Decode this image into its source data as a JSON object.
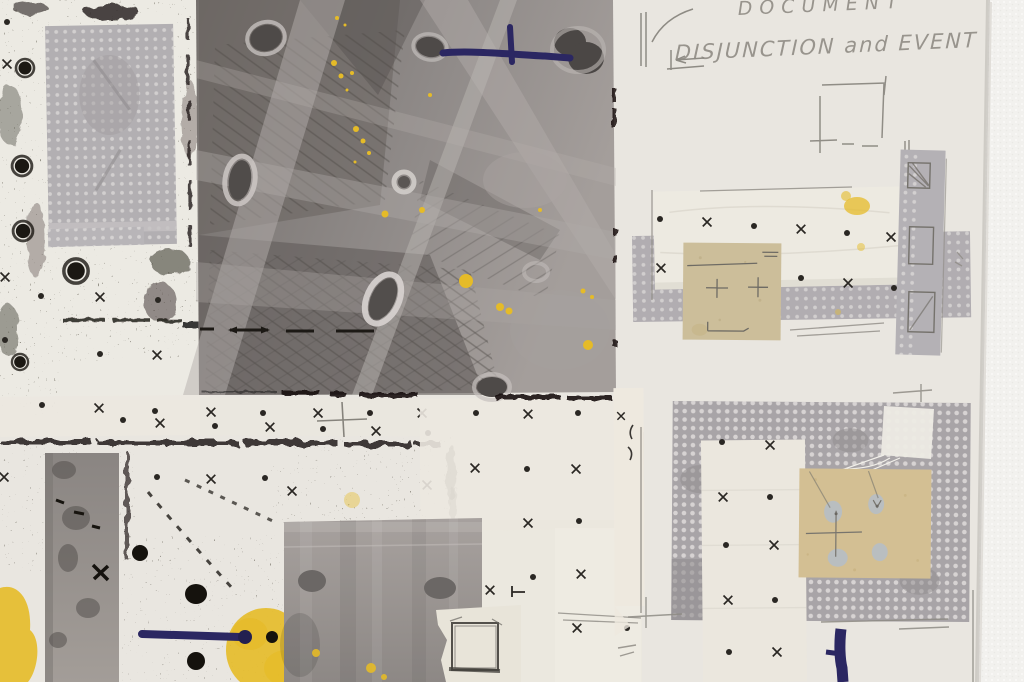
{
  "scene": {
    "kind": "photograph of a mixed-media collage artwork pinned on a white wall",
    "handwriting": {
      "line1": "DOCUMENT",
      "line2": "DISJUNCTION and EVENT"
    },
    "palette": {
      "wall_white": "#f2f1ee",
      "panel_cream": "#e9e6e0",
      "photo_gray": "#8e8987",
      "dotted_paper_gray": "#aeaaae",
      "tissue_white": "#ece8df",
      "tan_paper": "#cdbf9a",
      "charcoal_black": "#1d1a15",
      "marker_navy": "#2b2762",
      "paint_yellow": "#e5bb28",
      "pencil_gray": "#8d8a83",
      "pale_blue_blob": "#b7bec5"
    }
  }
}
